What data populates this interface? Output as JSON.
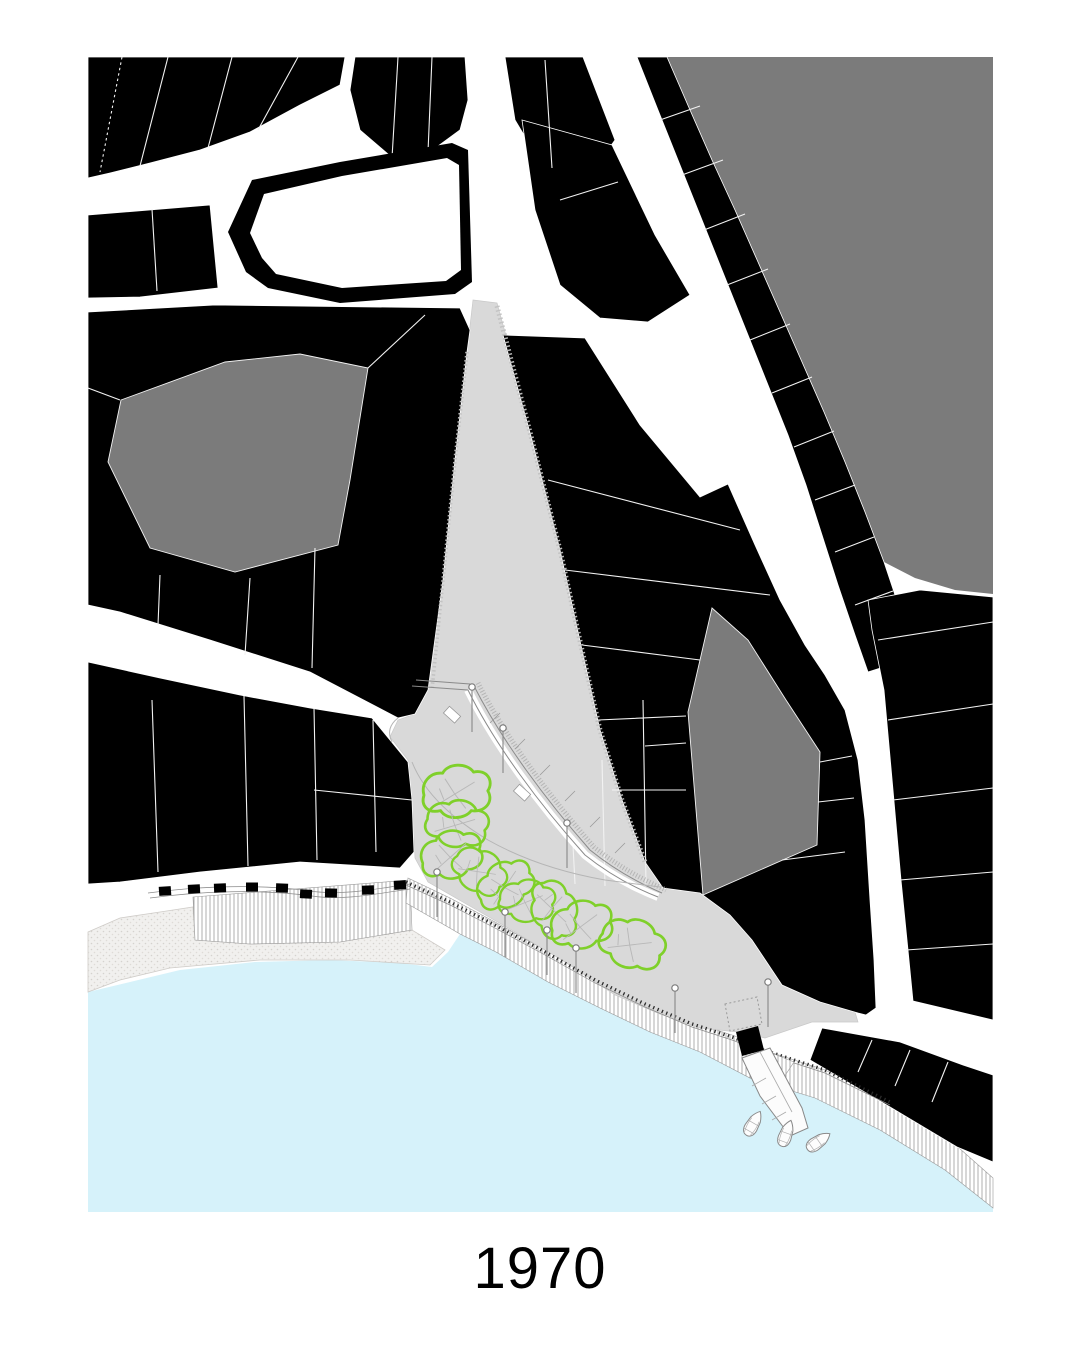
{
  "page": {
    "background": "#ffffff"
  },
  "caption": {
    "text": "1970"
  },
  "map": {
    "kind": "figure-ground waterfront site plan",
    "colors": {
      "page": "#ffffff",
      "building": "#000000",
      "block": "#7b7b7b",
      "plaza": "#d9d9d9",
      "water": "#d6f2fa",
      "street": "#ffffff",
      "tree": "#7fd02a",
      "parcel": "#f2f2f2",
      "caption": "#000000"
    },
    "features": {
      "church_buildings": 1,
      "tree_canopies": 9,
      "boats": 3,
      "bollards": 9,
      "lampposts": 9
    }
  }
}
